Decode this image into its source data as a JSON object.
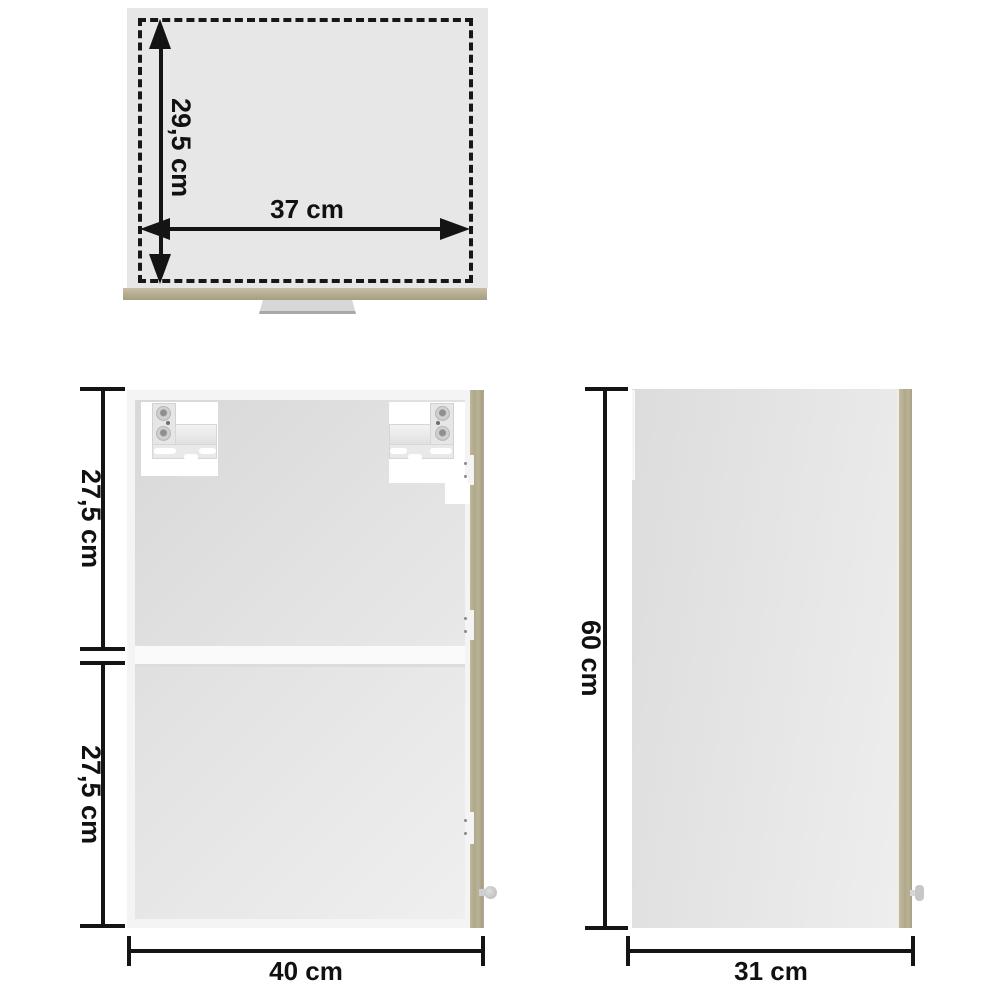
{
  "diagram": {
    "kind": "furniture-dimension-diagram",
    "views": {
      "top_view": {
        "depth_label": "29,5 cm",
        "width_label": "37 cm"
      },
      "front_view": {
        "upper_height_label": "27,5 cm",
        "lower_height_label": "27,5 cm",
        "width_label": "40 cm"
      },
      "side_view": {
        "height_label": "60 cm",
        "depth_label": "31 cm"
      }
    },
    "colors": {
      "background": "#ffffff",
      "panel_gray": "#e7e7e7",
      "wood_sonoma_oak": "#b3ab8e",
      "dimension_line": "#141414"
    }
  }
}
